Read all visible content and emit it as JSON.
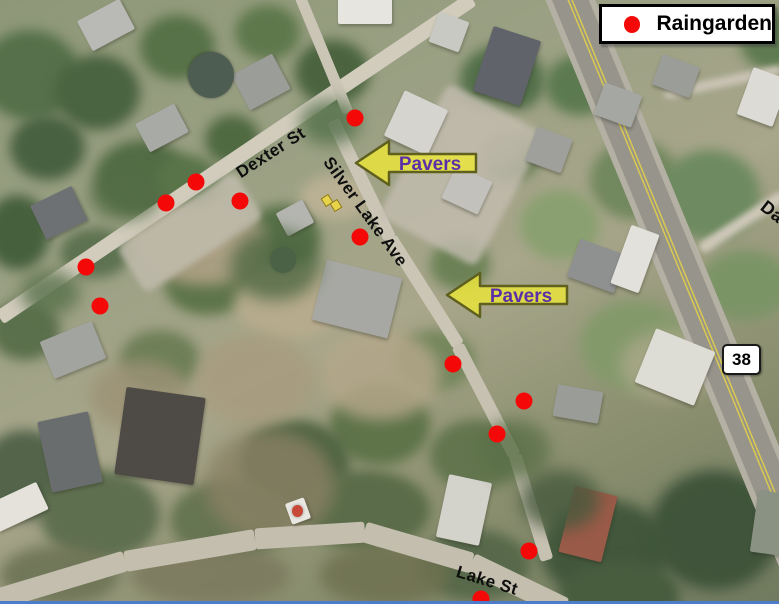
{
  "legend": {
    "label": "Raingarden"
  },
  "streets": {
    "dexter": "Dexter St",
    "silver_lake": "Silver Lake Ave",
    "lake": "Lake St",
    "partial_right_edge": "Da"
  },
  "route_shield": {
    "label": "38"
  },
  "pavers_annotations": [
    {
      "label": "Pavers"
    },
    {
      "label": "Pavers"
    }
  ],
  "raingarden_dots": [
    {
      "x": 355,
      "y": 118
    },
    {
      "x": 196,
      "y": 182
    },
    {
      "x": 166,
      "y": 203
    },
    {
      "x": 240,
      "y": 201
    },
    {
      "x": 86,
      "y": 267
    },
    {
      "x": 100,
      "y": 306
    },
    {
      "x": 360,
      "y": 237
    },
    {
      "x": 453,
      "y": 364
    },
    {
      "x": 524,
      "y": 401
    },
    {
      "x": 497,
      "y": 434
    },
    {
      "x": 529,
      "y": 551
    },
    {
      "x": 481,
      "y": 599
    }
  ],
  "colors": {
    "raingarden_dot": "#f40808",
    "pavers_arrow_fill": "#e9e43c",
    "pavers_arrow_outline": "#5f5f1e",
    "pavers_text": "#5b2fa8",
    "street_label": "#0e0e0e",
    "legend_background": "#ffffff",
    "legend_border": "#000000",
    "route_centerline_yellow": "#d9c94f",
    "bottom_edge_blue": "#4d7ccb"
  }
}
